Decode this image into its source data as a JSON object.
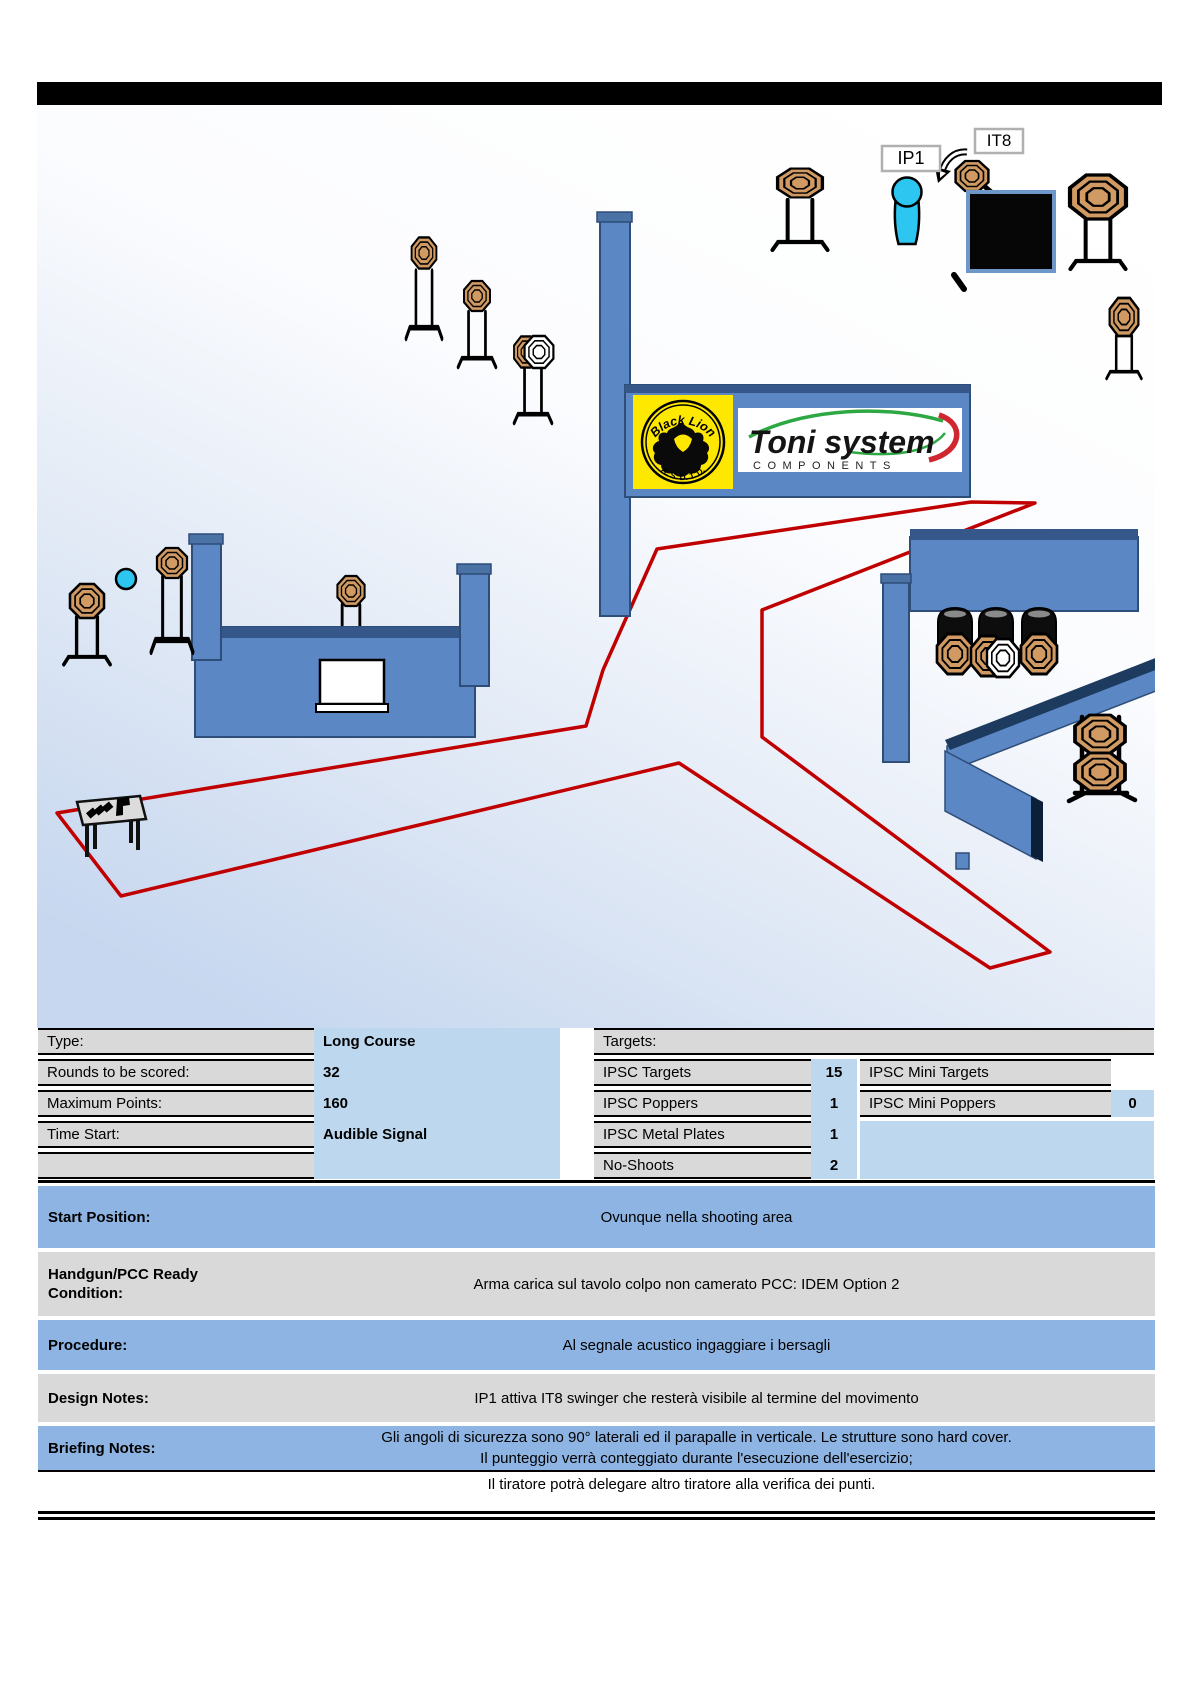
{
  "diagram": {
    "ip1_label": "IP1",
    "it8_label": "IT8",
    "sponsor_black_lion_top": "Black Lion",
    "sponsor_black_lion_bottom": "A. S. D. T. D.",
    "sponsor_toni_title": "Toni system",
    "sponsor_toni_sub": "COMPONENTS",
    "colors": {
      "wall_blue": "#5b87c4",
      "wall_dark": "#36578a",
      "fault_line_red": "#c00000",
      "target_tan": "#d09a62",
      "no_shoot_white": "#ffffff",
      "popper_cyan": "#2cc6f0",
      "black_box": "#060606",
      "logo_yellow": "#ffe800"
    }
  },
  "info": {
    "rows": [
      {
        "label": "Type:",
        "value": "Long Course"
      },
      {
        "label": "Rounds to be scored:",
        "value": "32"
      },
      {
        "label": "Maximum Points:",
        "value": "160"
      },
      {
        "label": "Time Start:",
        "value": "Audible Signal"
      }
    ],
    "targets_header": "Targets:",
    "target_rows": [
      {
        "label": "IPSC Targets",
        "value": "15"
      },
      {
        "label": "IPSC Poppers",
        "value": "1"
      },
      {
        "label": "IPSC Metal Plates",
        "value": "1"
      },
      {
        "label": "No-Shoots",
        "value": "2"
      }
    ],
    "mini_rows": [
      {
        "label": "IPSC Mini Targets",
        "value": ""
      },
      {
        "label": "IPSC Mini Poppers",
        "value": "0"
      }
    ]
  },
  "sections": {
    "start_position": {
      "label": "Start Position:",
      "text": "Ovunque nella shooting area"
    },
    "ready_condition": {
      "label": "Handgun/PCC Ready Condition:",
      "text": "Arma carica sul tavolo colpo non camerato PCC: IDEM Option 2"
    },
    "procedure": {
      "label": "Procedure:",
      "text": "Al segnale acustico ingaggiare i bersagli"
    },
    "design_notes": {
      "label": "Design Notes:",
      "text": "IP1 attiva IT8 swinger che resterà visibile al termine del movimento"
    },
    "briefing_notes": {
      "label": "Briefing Notes:",
      "line1": "Gli angoli di sicurezza sono 90° laterali ed il parapalle in verticale. Le strutture sono hard cover.",
      "line2": "Il punteggio verrà conteggiato durante l'esecuzione dell'esercizio;",
      "line3": "Il tiratore potrà delegare altro tiratore alla verifica dei punti."
    }
  }
}
